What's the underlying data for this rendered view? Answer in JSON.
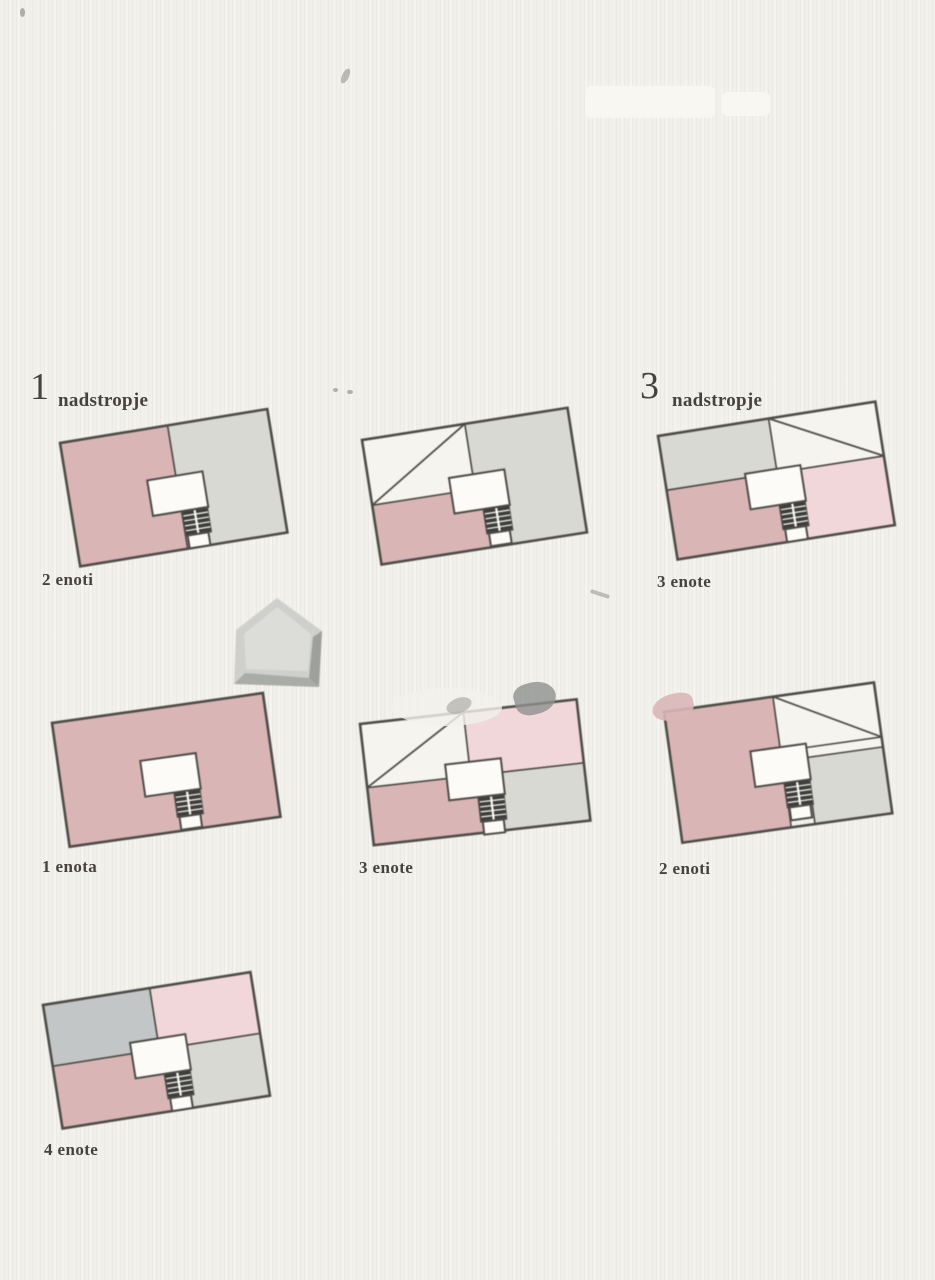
{
  "colors": {
    "background": "#f1f0eb",
    "outline": "#4e4c48",
    "unit_pink": "#d9b5b5",
    "unit_pink_light": "#f1d7da",
    "unit_gray": "#d9d9d4",
    "unit_gray_dark": "#c2c6c6",
    "void_white": "#f5f4ef",
    "landing_white": "#fcfbf7",
    "stairs_dark": "#3e3e3c",
    "text": "#46433f",
    "house_base": "#cfd0cc",
    "house_inner": "#dcdcd8",
    "house_bevel_right": "#9da09d",
    "house_bevel_bottom": "#aaaca8"
  },
  "icons": {
    "house": "house-icon"
  },
  "plans": [
    {
      "id": "top-left",
      "floor_number": "1",
      "floor_name": "nadstropje",
      "units": "2 enoti"
    },
    {
      "id": "top-center"
    },
    {
      "id": "top-right",
      "floor_number": "3",
      "floor_name": "nadstropje",
      "units": "3 enote"
    },
    {
      "id": "mid-left",
      "units": "1 enota"
    },
    {
      "id": "mid-center",
      "units": "3 enote"
    },
    {
      "id": "mid-right",
      "units": "2 enoti"
    },
    {
      "id": "bottom-left",
      "units": "4 enote"
    }
  ]
}
